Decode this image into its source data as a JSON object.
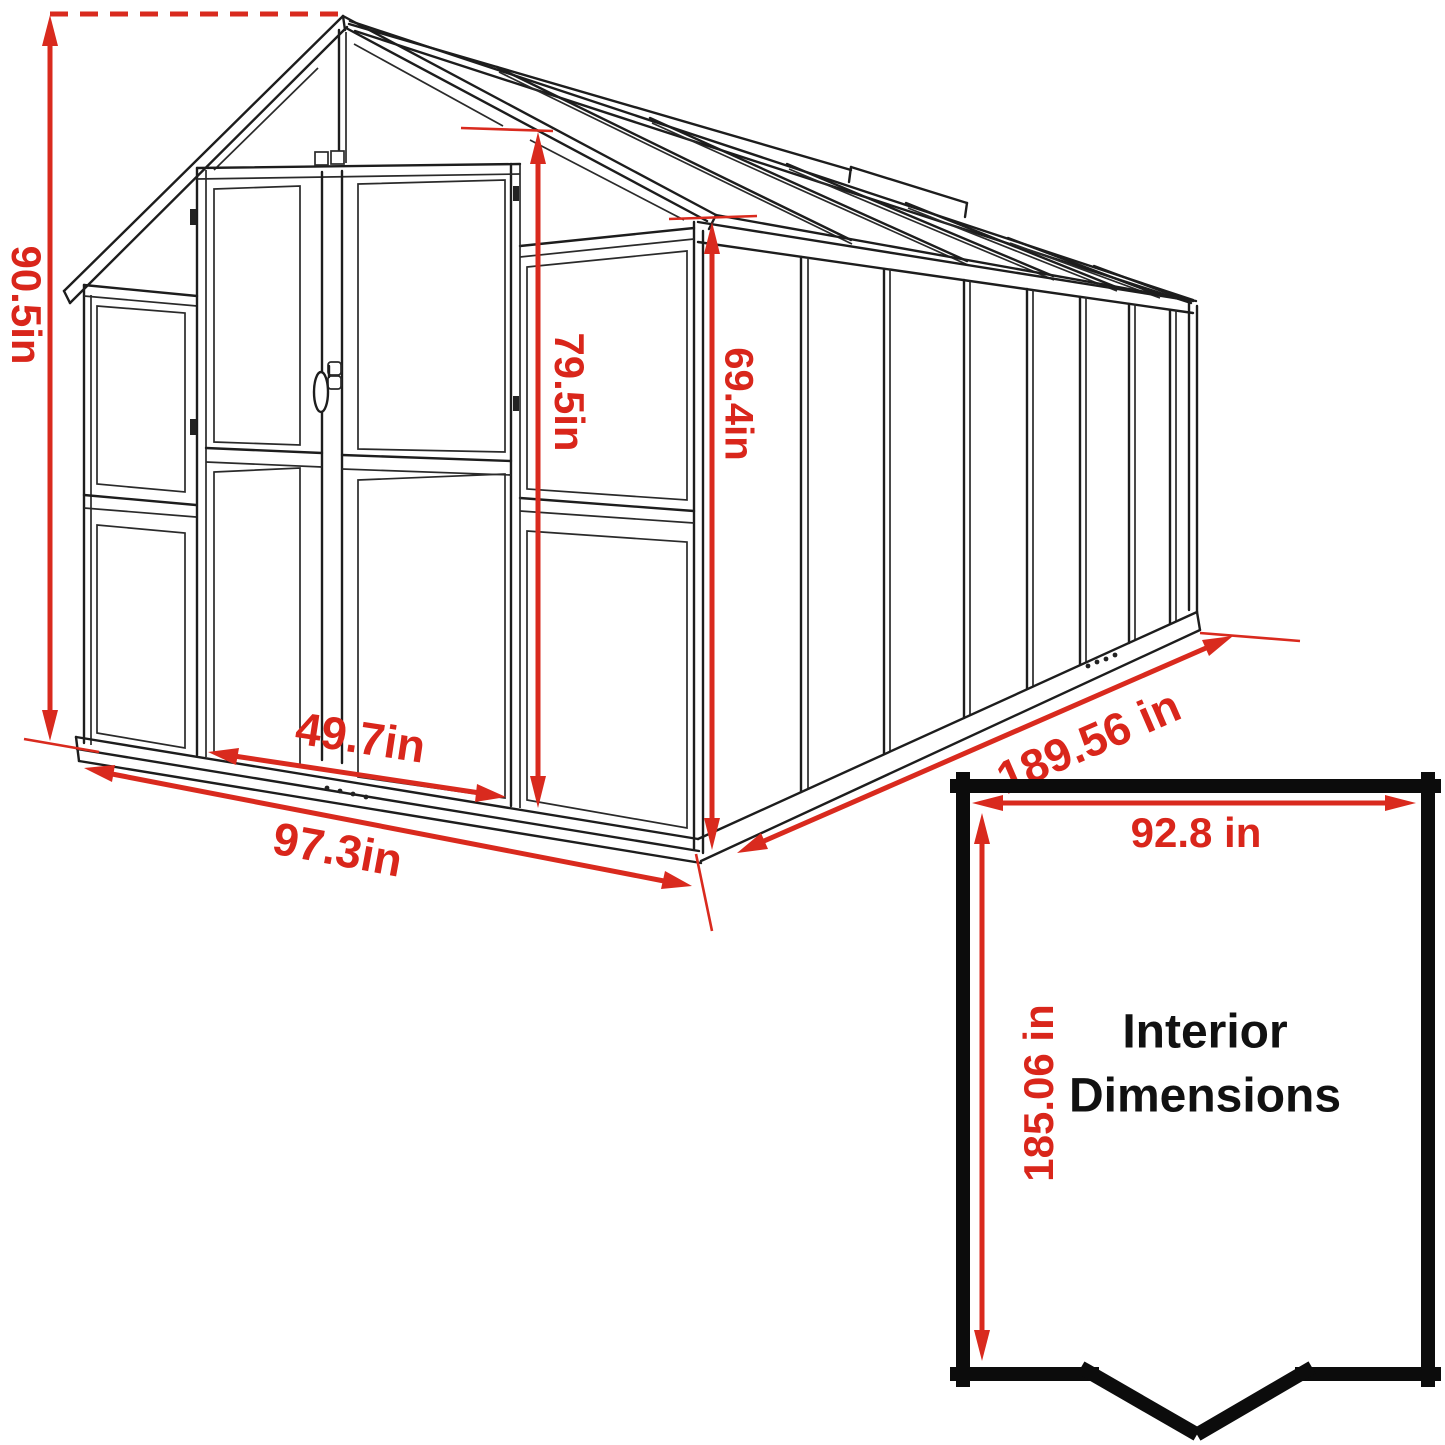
{
  "diagram": {
    "type": "greenhouse-dimension-drawing",
    "accent_color": "#d92a1e",
    "line_color": "#1d1d1d",
    "dimensions": {
      "overall_height": "90.5in",
      "door_height": "79.5in",
      "wall_height": "69.4in",
      "door_width": "49.7in",
      "front_width": "97.3in",
      "side_length": "189.56 in"
    },
    "interior": {
      "title_line1": "Interior",
      "title_line2": "Dimensions",
      "width": "92.8 in",
      "depth": "185.06 in"
    }
  }
}
